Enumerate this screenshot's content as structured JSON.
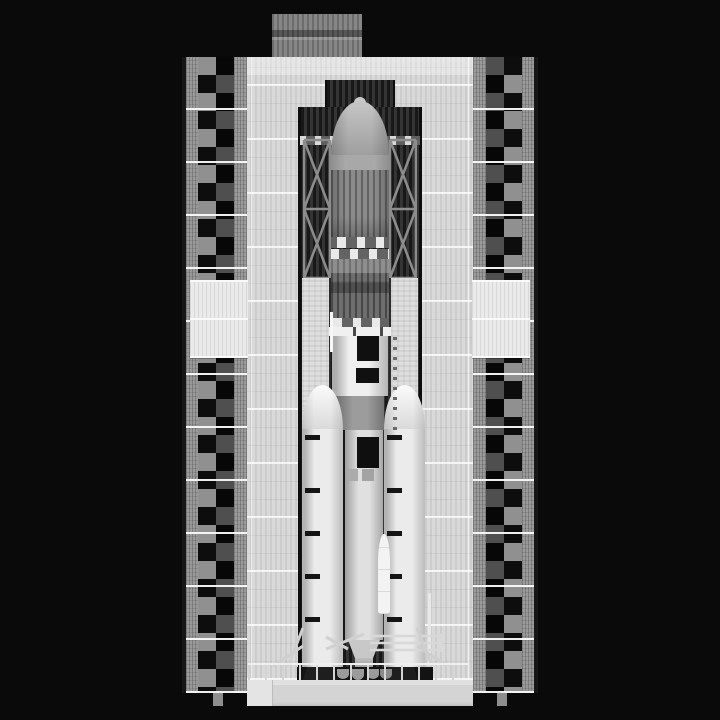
{
  "scene": {
    "name": "rocket-in-launch-tower",
    "description": "Grayscale 2D side view of a heavy-lift rocket with a payload fairing and twin solid boosters standing inside a tall launch service tower against a black night sky.",
    "aria": {
      "stage": "Launch gantry scene",
      "facade": "Service tower facade",
      "left_column": "Left checkered tower column",
      "right_column": "Right checkered tower column",
      "roof_box": "Rooftop machinery house",
      "bay": "Central service bay opening",
      "bridge": "Crane bridge",
      "left_truss": "Left service truss",
      "right_truss": "Right service truss",
      "left_pillar": "Left platform pillar",
      "right_pillar": "Right platform pillar",
      "fairing": "Payload fairing",
      "second_stage": "Upper stage",
      "interstage": "Interstage ring",
      "core_stage": "Core stage",
      "left_booster": "Left solid rocket booster",
      "right_booster": "Right solid rocket booster",
      "engine_pit": "Engine pit",
      "railing": "Platform railing",
      "slab": "Launch platform slab"
    }
  },
  "palette": {
    "background": "#0a0a0a",
    "facade": "#d9d9d9",
    "checker_light": "#909090",
    "checker_dark": "#0d0d0d",
    "bay_dark": "#2a2a2a",
    "roof_box": "#868686",
    "fairing_gray": "#8b8b8b",
    "fairing_marking_white": "#e9e9e9",
    "stage_white": "#efefef",
    "interstage_gray": "#8f8f8f",
    "booster_white": "#ebebeb",
    "marking_black": "#141414",
    "pit_black": "#131313",
    "slab_gray": "#d4d4d4"
  }
}
